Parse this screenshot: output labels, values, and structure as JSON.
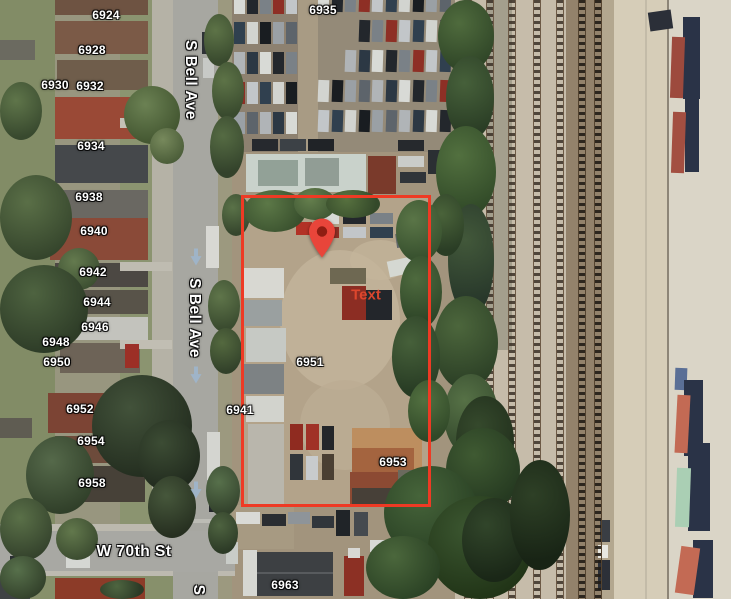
{
  "app": {
    "name": "satellite-map-view",
    "view_type": "satellite"
  },
  "map": {
    "street_labels": [
      {
        "text": "S Bell Ave",
        "orientation": "vertical",
        "x": 190,
        "y": 80
      },
      {
        "text": "S Bell Ave",
        "orientation": "vertical",
        "x": 194,
        "y": 318
      },
      {
        "text": "S",
        "orientation": "vertical",
        "x": 198,
        "y": 590
      },
      {
        "text": "W 70th St",
        "orientation": "horizontal",
        "x": 134,
        "y": 552
      }
    ],
    "house_number_labels": [
      {
        "text": "6924",
        "x": 106,
        "y": 15
      },
      {
        "text": "6928",
        "x": 92,
        "y": 50
      },
      {
        "text": "6930",
        "x": 55,
        "y": 85
      },
      {
        "text": "6932",
        "x": 90,
        "y": 86
      },
      {
        "text": "6934",
        "x": 91,
        "y": 146
      },
      {
        "text": "6935",
        "x": 323,
        "y": 10
      },
      {
        "text": "6938",
        "x": 89,
        "y": 197
      },
      {
        "text": "6940",
        "x": 94,
        "y": 231
      },
      {
        "text": "6942",
        "x": 93,
        "y": 272
      },
      {
        "text": "6944",
        "x": 97,
        "y": 302
      },
      {
        "text": "6946",
        "x": 95,
        "y": 327
      },
      {
        "text": "6948",
        "x": 56,
        "y": 342
      },
      {
        "text": "6950",
        "x": 57,
        "y": 362
      },
      {
        "text": "6941",
        "x": 240,
        "y": 410
      },
      {
        "text": "6951",
        "x": 310,
        "y": 362
      },
      {
        "text": "6952",
        "x": 80,
        "y": 409
      },
      {
        "text": "6953",
        "x": 393,
        "y": 462
      },
      {
        "text": "6954",
        "x": 91,
        "y": 441
      },
      {
        "text": "6958",
        "x": 92,
        "y": 483
      },
      {
        "text": "6963",
        "x": 285,
        "y": 585
      }
    ],
    "annotation": {
      "text": "Text",
      "x": 366,
      "y": 295,
      "color": "#e2482e"
    },
    "marker": {
      "label": "map-pin",
      "x": 322,
      "y": 258,
      "body_color": "#e8453a",
      "dot_color": "#8f1d12"
    },
    "boundary_rectangle": {
      "x": 241,
      "y": 195,
      "width": 190,
      "height": 312,
      "stroke_color": "#ee3a24",
      "stroke_width": 3
    },
    "one_way_arrows": [
      {
        "x": 196,
        "y": 257
      },
      {
        "x": 196,
        "y": 375
      },
      {
        "x": 196,
        "y": 490
      }
    ],
    "arrow_color": "#9fb6cc",
    "label_color": "#ffffff"
  }
}
